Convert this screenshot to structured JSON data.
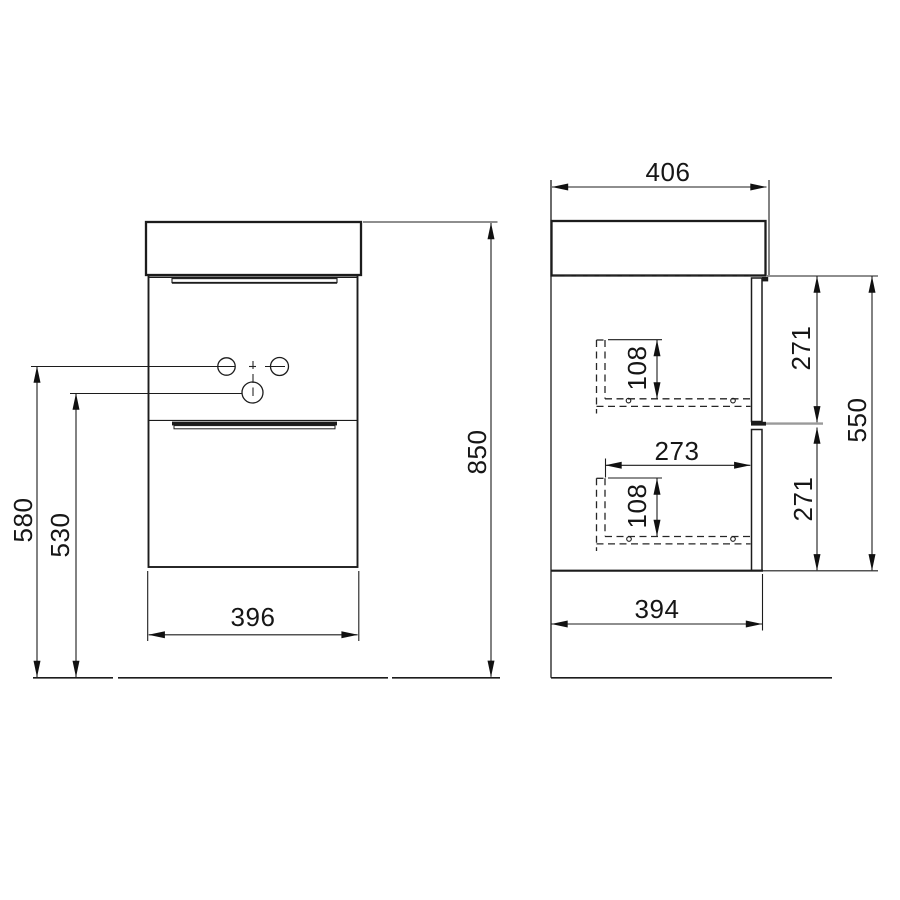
{
  "drawing": {
    "type": "furniture-dimension-drawing",
    "subject": "wall-hung washbasin vanity cabinet with two drawers",
    "colors": {
      "background": "#ffffff",
      "line": "#1c1c1c",
      "hidden_line": "#262626",
      "divider_extension": "#9a9a9a"
    },
    "views": {
      "front": {
        "dims": {
          "total_height": "850",
          "faucet_holes_height": "580",
          "drain_height": "530",
          "width": "396"
        }
      },
      "side": {
        "dims": {
          "top_depth": "406",
          "body_depth": "394",
          "body_height": "550",
          "upper_drawer_height": "271",
          "lower_drawer_height": "271",
          "upper_rail_offset": "108",
          "lower_rail_offset": "108",
          "rail_length": "273"
        }
      }
    }
  }
}
